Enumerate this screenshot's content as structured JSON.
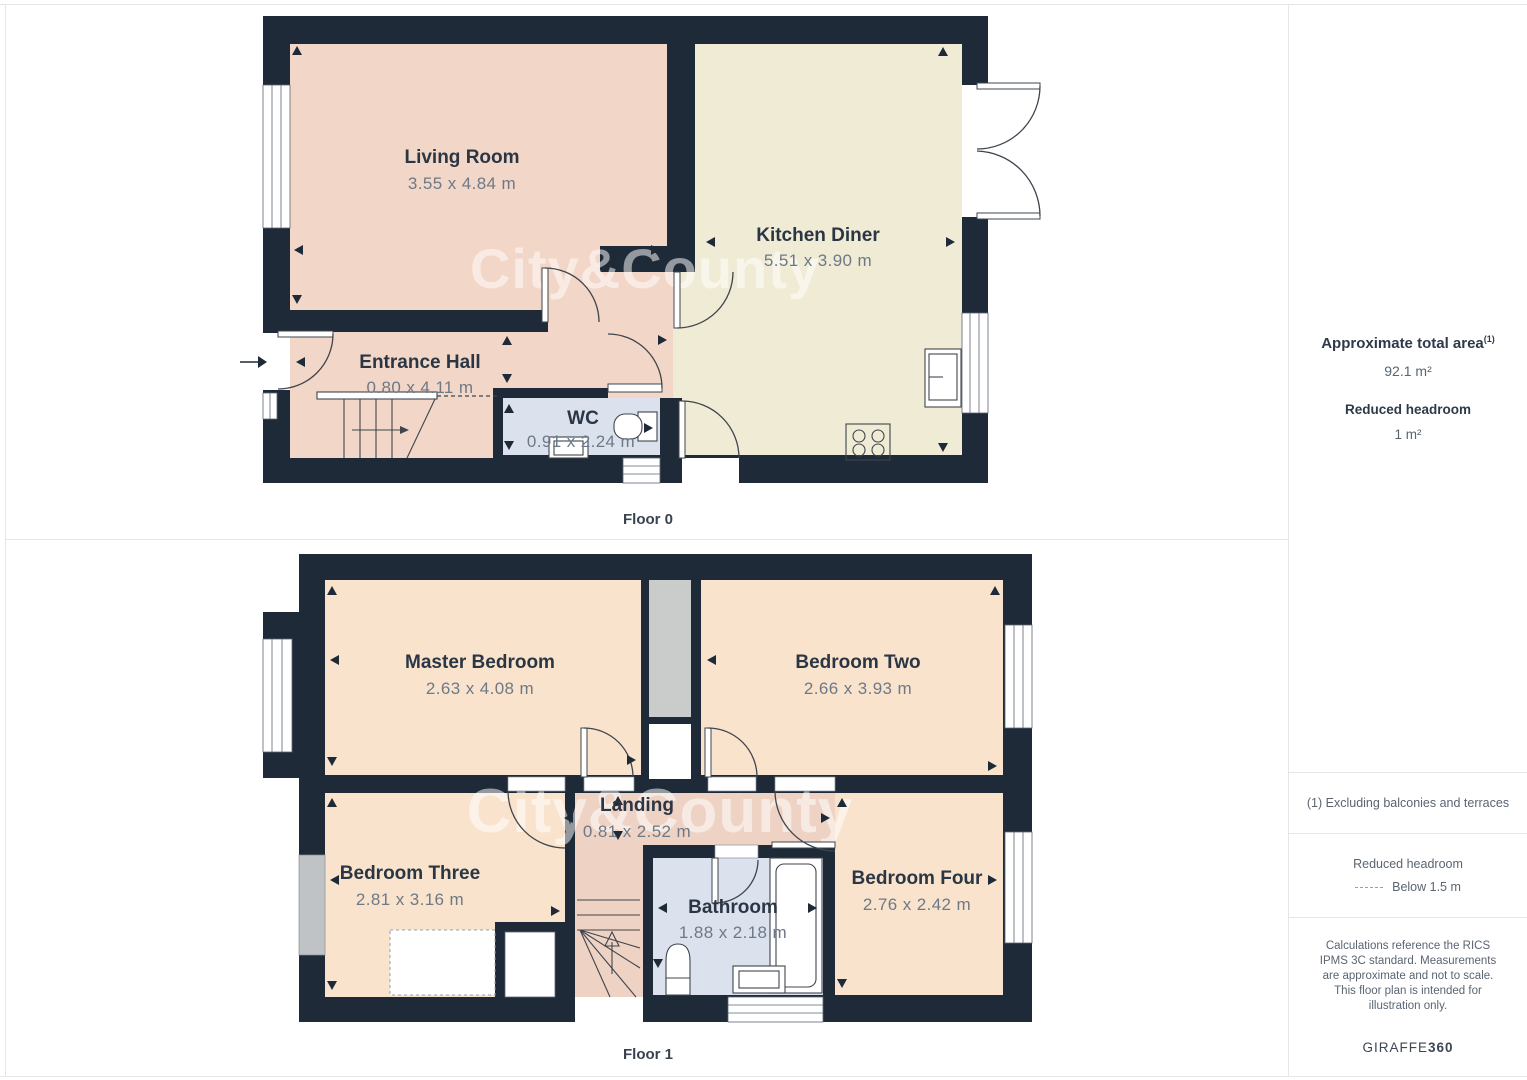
{
  "watermark": {
    "text": "City&County"
  },
  "colors": {
    "wall": "#1e2a37",
    "hall_pink": "#f2d6c7",
    "kitchen_cream": "#f0ebd5",
    "wet_blue": "#dce1ee",
    "bedroom_peach": "#f9e3cd",
    "landing_salmon": "#eed3c4",
    "shaft_gray": "#c9cccb",
    "window_gray": "#bfc3c5"
  },
  "floor0": {
    "label": "Floor 0",
    "rooms": [
      {
        "name": "Living Room",
        "dims": "3.55 x 4.84 m"
      },
      {
        "name": "Kitchen Diner",
        "dims": "5.51 x 3.90 m"
      },
      {
        "name": "Entrance Hall",
        "dims": "0.80 x 4.11 m"
      },
      {
        "name": "WC",
        "dims": "0.91 x 2.24 m"
      }
    ]
  },
  "floor1": {
    "label": "Floor 1",
    "rooms": [
      {
        "name": "Master Bedroom",
        "dims": "2.63 x 4.08 m"
      },
      {
        "name": "Bedroom Two",
        "dims": "2.66 x 3.93 m"
      },
      {
        "name": "Bedroom Three",
        "dims": "2.81 x 3.16 m"
      },
      {
        "name": "Landing",
        "dims": "0.81 x 2.52 m"
      },
      {
        "name": "Bathroom",
        "dims": "1.88 x 2.18 m"
      },
      {
        "name": "Bedroom Four",
        "dims": "2.76 x 2.42 m"
      }
    ]
  },
  "sidebar": {
    "total_area_label": "Approximate total area",
    "total_area_sup": "(1)",
    "total_area_value": "92.1 m²",
    "reduced_label": "Reduced headroom",
    "reduced_value": "1 m²",
    "note1": "(1) Excluding balconies and terraces",
    "legend_title": "Reduced headroom",
    "legend_item": "Below 1.5 m",
    "disclaimer": "Calculations reference the RICS IPMS 3C standard. Measurements are approximate and not to scale. This floor plan is intended for illustration only.",
    "brand": "GIRAFFE",
    "brand_bold": "360"
  }
}
